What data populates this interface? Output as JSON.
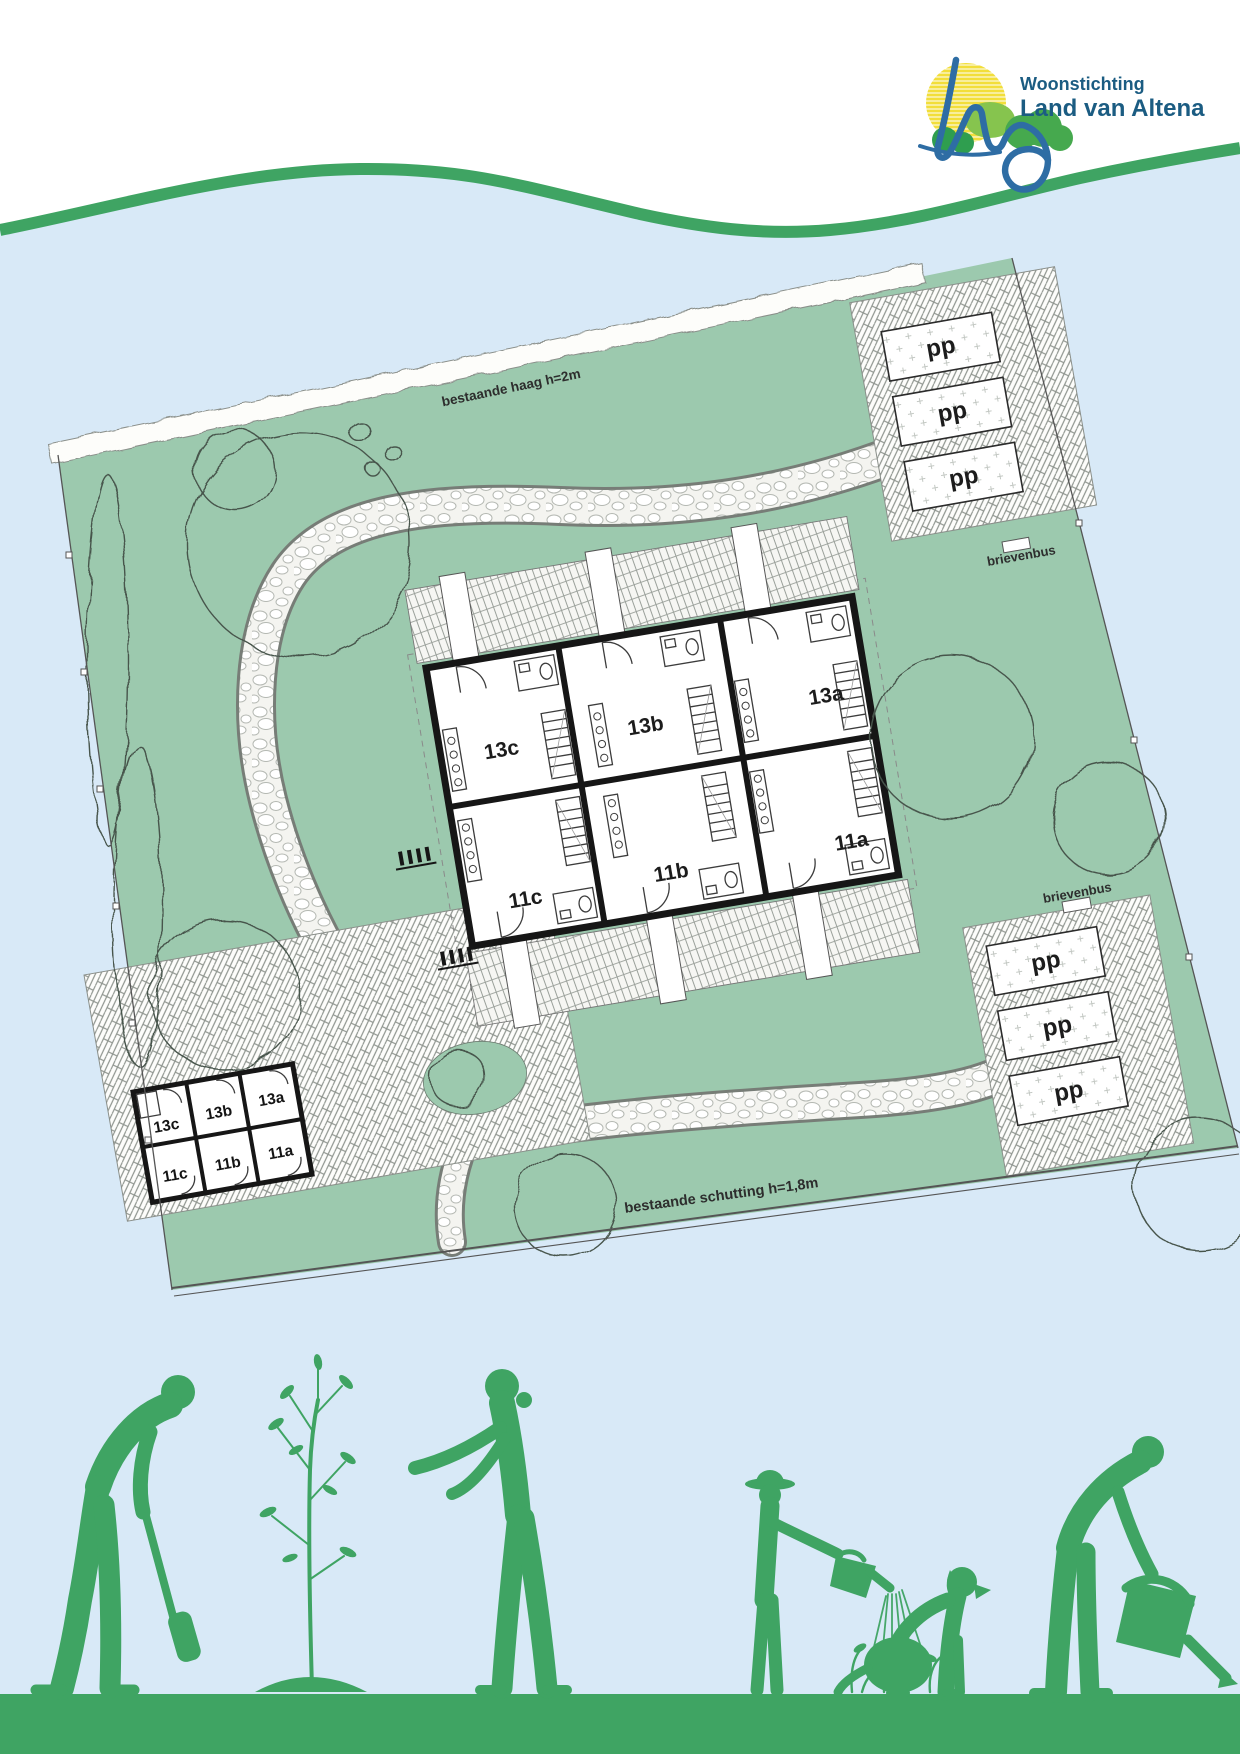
{
  "logo": {
    "name_line1": "Woonstichting",
    "name_line2": "Land van Altena",
    "text_color": "#1b5c82",
    "sun_yellow": "#f2de3a",
    "cloud_green_light": "#86c44e",
    "cloud_green_dark": "#3d9e4e",
    "swoosh_blue": "#2e6da4"
  },
  "site_plan": {
    "hedge_label": "bestaande haag h=2m",
    "fence_label": "bestaande schutting h=1,8m",
    "mailbox_top_label": "brievenbus",
    "mailbox_right_label": "brievenbus",
    "parking_spot_label": "pp",
    "building": {
      "units": [
        {
          "label": "13c"
        },
        {
          "label": "13b"
        },
        {
          "label": "13a"
        },
        {
          "label": "11c"
        },
        {
          "label": "11b"
        },
        {
          "label": "11a"
        }
      ]
    },
    "shed": {
      "units": [
        {
          "label": "13c"
        },
        {
          "label": "13b"
        },
        {
          "label": "13a"
        },
        {
          "label": "11c"
        },
        {
          "label": "11b"
        },
        {
          "label": "11a"
        }
      ]
    },
    "colors": {
      "lawn_green": "#9cc9ae",
      "page_blue": "#d8e9f7",
      "wall_black": "#161616",
      "paving_line_gray": "#9aa09a",
      "accent_green": "#3fa463"
    }
  },
  "footer_illustration": {
    "figures": [
      "person-digging",
      "young-tree",
      "woman-planting",
      "child-watering",
      "watered-plants",
      "dog-sitting",
      "person-watering-can"
    ]
  }
}
